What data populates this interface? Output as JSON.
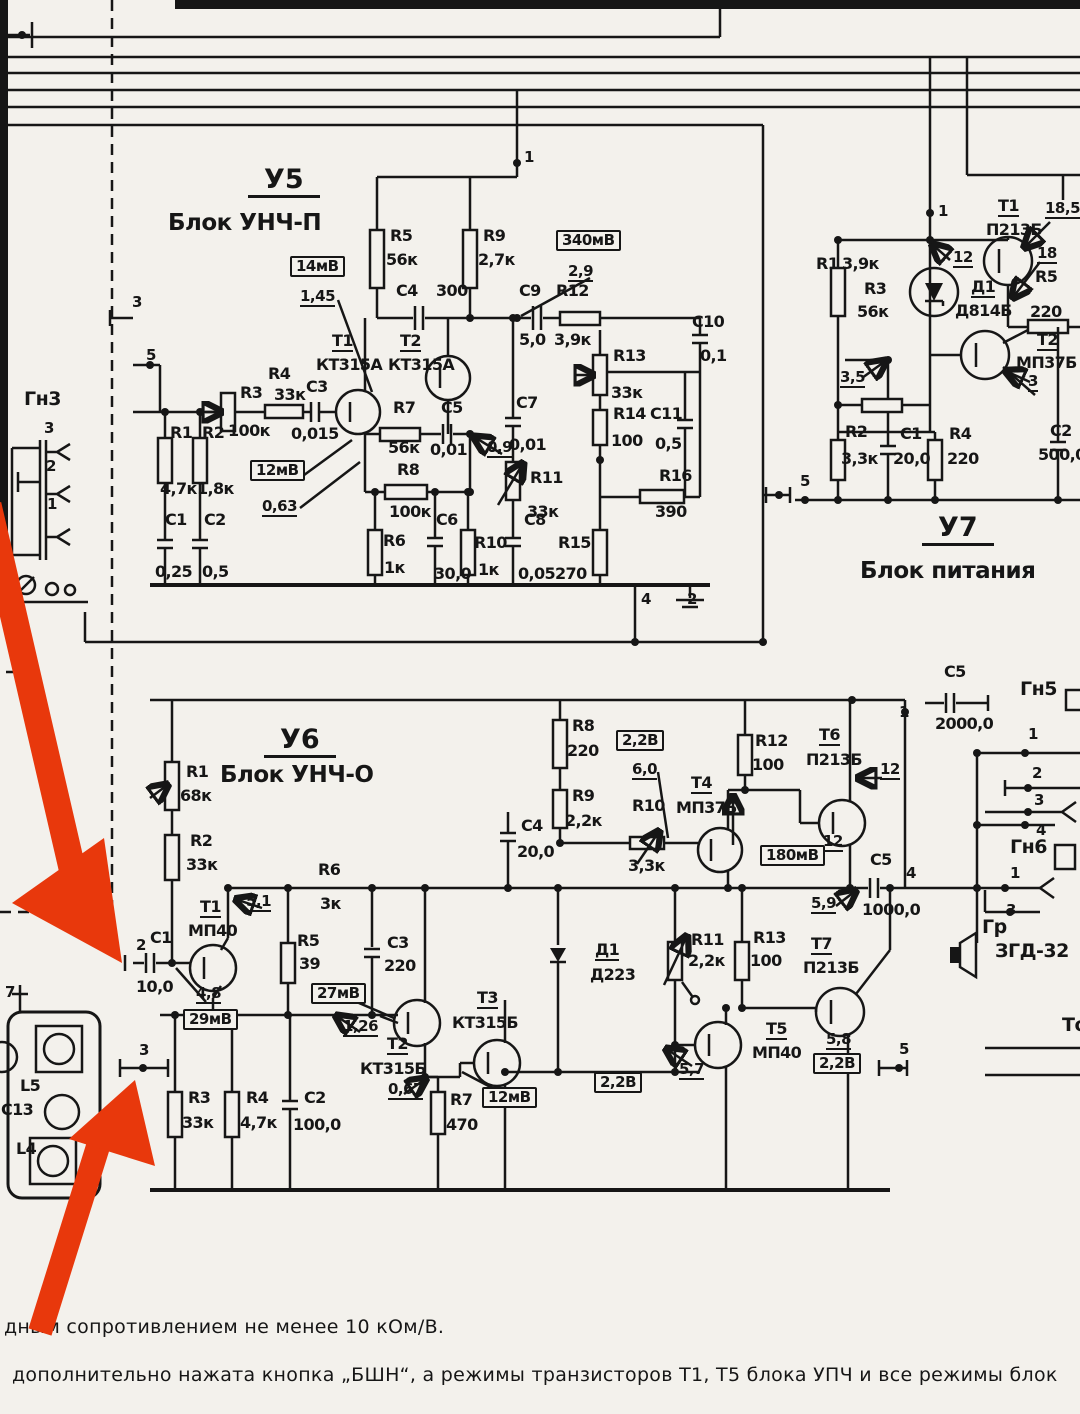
{
  "canvas": {
    "width": 1080,
    "height": 1414,
    "bg": "#f3f1ec",
    "ink": "#161616"
  },
  "arrow": {
    "color": "#e8380c",
    "count": 2,
    "meaning": "red annotation arrows"
  },
  "blocks": [
    {
      "id": "У5",
      "name": "Блок УНЧ-П"
    },
    {
      "id": "У6",
      "name": "Блок УНЧ-О"
    },
    {
      "id": "У7",
      "name": "Блок питания"
    }
  ],
  "connectors": [
    "Гн3",
    "Гн5",
    "Гн6",
    "Гр ЗГД-32"
  ],
  "notes": [
    "дным  сопротивлением не менее  10 кОм/В.",
    "дополнительно нажата кнопка „БШН“, а режимы транзисторов Т1, Т5 блока УПЧ и все режимы блок"
  ],
  "labels": [
    {
      "t": "У5",
      "x": 248,
      "y": 166,
      "s": "t1",
      "n": "block-u5-id"
    },
    {
      "t": "Блок УНЧ-П",
      "x": 168,
      "y": 212,
      "s": "t2",
      "n": "block-u5-name"
    },
    {
      "t": "1",
      "x": 524,
      "y": 150,
      "s": "p"
    },
    {
      "t": "R5",
      "x": 390,
      "y": 228,
      "s": "r"
    },
    {
      "t": "56к",
      "x": 386,
      "y": 252,
      "s": "r"
    },
    {
      "t": "R9",
      "x": 483,
      "y": 228,
      "s": "r"
    },
    {
      "t": "2,7к",
      "x": 478,
      "y": 252,
      "s": "r"
    },
    {
      "t": "14мВ",
      "x": 290,
      "y": 256,
      "s": "b"
    },
    {
      "t": "1,45",
      "x": 300,
      "y": 289,
      "s": "m"
    },
    {
      "t": "340мВ",
      "x": 556,
      "y": 230,
      "s": "b"
    },
    {
      "t": "2,9",
      "x": 568,
      "y": 264,
      "s": "m"
    },
    {
      "t": "C4",
      "x": 396,
      "y": 283,
      "s": "r"
    },
    {
      "t": "300",
      "x": 436,
      "y": 283,
      "s": "r"
    },
    {
      "t": "C9",
      "x": 519,
      "y": 283,
      "s": "r"
    },
    {
      "t": "5,0",
      "x": 519,
      "y": 332,
      "s": "r"
    },
    {
      "t": "R12",
      "x": 556,
      "y": 283,
      "s": "r"
    },
    {
      "t": "3,9к",
      "x": 554,
      "y": 332,
      "s": "r"
    },
    {
      "t": "T1",
      "x": 332,
      "y": 333,
      "s": "d"
    },
    {
      "t": "КТ315А",
      "x": 316,
      "y": 357,
      "s": "r"
    },
    {
      "t": "T2",
      "x": 400,
      "y": 333,
      "s": "d"
    },
    {
      "t": "КТ315А",
      "x": 388,
      "y": 357,
      "s": "r"
    },
    {
      "t": "R3",
      "x": 240,
      "y": 385,
      "s": "r"
    },
    {
      "t": "100к",
      "x": 228,
      "y": 423,
      "s": "r"
    },
    {
      "t": "R4",
      "x": 268,
      "y": 366,
      "s": "r"
    },
    {
      "t": "33к",
      "x": 274,
      "y": 387,
      "s": "r"
    },
    {
      "t": "C3",
      "x": 306,
      "y": 379,
      "s": "r"
    },
    {
      "t": "0,015",
      "x": 291,
      "y": 426,
      "s": "r"
    },
    {
      "t": "12мВ",
      "x": 250,
      "y": 460,
      "s": "b"
    },
    {
      "t": "0,63",
      "x": 262,
      "y": 499,
      "s": "m"
    },
    {
      "t": "R1",
      "x": 170,
      "y": 425,
      "s": "r"
    },
    {
      "t": "4,7к",
      "x": 160,
      "y": 481,
      "s": "r"
    },
    {
      "t": "R2",
      "x": 202,
      "y": 425,
      "s": "r"
    },
    {
      "t": "1,8к",
      "x": 197,
      "y": 481,
      "s": "r"
    },
    {
      "t": "C1",
      "x": 165,
      "y": 512,
      "s": "r"
    },
    {
      "t": "0,25",
      "x": 155,
      "y": 564,
      "s": "r"
    },
    {
      "t": "C2",
      "x": 204,
      "y": 512,
      "s": "r"
    },
    {
      "t": "0,5",
      "x": 202,
      "y": 564,
      "s": "r"
    },
    {
      "t": "R7",
      "x": 393,
      "y": 400,
      "s": "r"
    },
    {
      "t": "56к",
      "x": 388,
      "y": 440,
      "s": "r"
    },
    {
      "t": "C5",
      "x": 441,
      "y": 400,
      "s": "r"
    },
    {
      "t": "0,01",
      "x": 430,
      "y": 442,
      "s": "r"
    },
    {
      "t": "0,9",
      "x": 487,
      "y": 440,
      "s": "m"
    },
    {
      "t": "R8",
      "x": 397,
      "y": 462,
      "s": "r"
    },
    {
      "t": "100к",
      "x": 389,
      "y": 504,
      "s": "r"
    },
    {
      "t": "R6",
      "x": 383,
      "y": 533,
      "s": "r"
    },
    {
      "t": "1к",
      "x": 384,
      "y": 560,
      "s": "r"
    },
    {
      "t": "C6",
      "x": 436,
      "y": 512,
      "s": "r"
    },
    {
      "t": "30,0",
      "x": 434,
      "y": 566,
      "s": "r"
    },
    {
      "t": "R10",
      "x": 474,
      "y": 535,
      "s": "r"
    },
    {
      "t": "1к",
      "x": 478,
      "y": 562,
      "s": "r"
    },
    {
      "t": "C8",
      "x": 524,
      "y": 512,
      "s": "r"
    },
    {
      "t": "0,05",
      "x": 518,
      "y": 566,
      "s": "r"
    },
    {
      "t": "R15",
      "x": 558,
      "y": 535,
      "s": "r"
    },
    {
      "t": "270",
      "x": 555,
      "y": 566,
      "s": "r"
    },
    {
      "t": "C7",
      "x": 516,
      "y": 395,
      "s": "r"
    },
    {
      "t": "0,01",
      "x": 509,
      "y": 437,
      "s": "r"
    },
    {
      "t": "R11",
      "x": 530,
      "y": 470,
      "s": "r"
    },
    {
      "t": "33к",
      "x": 527,
      "y": 504,
      "s": "r"
    },
    {
      "t": "R13",
      "x": 613,
      "y": 348,
      "s": "r"
    },
    {
      "t": "33к",
      "x": 611,
      "y": 385,
      "s": "r"
    },
    {
      "t": "R14",
      "x": 613,
      "y": 406,
      "s": "r"
    },
    {
      "t": "100",
      "x": 611,
      "y": 433,
      "s": "r"
    },
    {
      "t": "C11",
      "x": 650,
      "y": 406,
      "s": "r"
    },
    {
      "t": "0,5",
      "x": 655,
      "y": 436,
      "s": "r"
    },
    {
      "t": "C10",
      "x": 692,
      "y": 314,
      "s": "r"
    },
    {
      "t": "0,1",
      "x": 700,
      "y": 348,
      "s": "r"
    },
    {
      "t": "R16",
      "x": 659,
      "y": 468,
      "s": "r"
    },
    {
      "t": "390",
      "x": 655,
      "y": 504,
      "s": "r"
    },
    {
      "t": "4",
      "x": 641,
      "y": 592,
      "s": "p"
    },
    {
      "t": "2",
      "x": 687,
      "y": 592,
      "s": "p"
    },
    {
      "t": "3",
      "x": 132,
      "y": 295,
      "s": "p"
    },
    {
      "t": "5",
      "x": 146,
      "y": 348,
      "s": "p"
    },
    {
      "t": "1",
      "x": 938,
      "y": 204,
      "s": "p"
    },
    {
      "t": "T1",
      "x": 998,
      "y": 198,
      "s": "d"
    },
    {
      "t": "П213Б",
      "x": 986,
      "y": 222,
      "s": "r"
    },
    {
      "t": "18,5",
      "x": 1045,
      "y": 201,
      "s": "m"
    },
    {
      "t": "12",
      "x": 953,
      "y": 250,
      "s": "m"
    },
    {
      "t": "R1",
      "x": 816,
      "y": 256,
      "s": "r"
    },
    {
      "t": "3,9к",
      "x": 842,
      "y": 256,
      "s": "r"
    },
    {
      "t": "R3",
      "x": 864,
      "y": 281,
      "s": "r"
    },
    {
      "t": "56к",
      "x": 857,
      "y": 304,
      "s": "r"
    },
    {
      "t": "Д1",
      "x": 971,
      "y": 279,
      "s": "d"
    },
    {
      "t": "Д814Б",
      "x": 955,
      "y": 303,
      "s": "r"
    },
    {
      "t": "R5",
      "x": 1035,
      "y": 269,
      "s": "r"
    },
    {
      "t": "220",
      "x": 1030,
      "y": 304,
      "s": "r"
    },
    {
      "t": "18",
      "x": 1037,
      "y": 246,
      "s": "m"
    },
    {
      "t": "T2",
      "x": 1037,
      "y": 332,
      "s": "d"
    },
    {
      "t": "МП37Б",
      "x": 1016,
      "y": 355,
      "s": "r"
    },
    {
      "t": "3",
      "x": 1028,
      "y": 374,
      "s": "m"
    },
    {
      "t": "3,5",
      "x": 840,
      "y": 370,
      "s": "m"
    },
    {
      "t": "R2",
      "x": 845,
      "y": 424,
      "s": "r"
    },
    {
      "t": "3,3к",
      "x": 841,
      "y": 451,
      "s": "r"
    },
    {
      "t": "C1",
      "x": 900,
      "y": 426,
      "s": "r"
    },
    {
      "t": "20,0",
      "x": 893,
      "y": 451,
      "s": "r"
    },
    {
      "t": "R4",
      "x": 949,
      "y": 426,
      "s": "r"
    },
    {
      "t": "220",
      "x": 947,
      "y": 451,
      "s": "r"
    },
    {
      "t": "C2",
      "x": 1050,
      "y": 423,
      "s": "r"
    },
    {
      "t": "500,0",
      "x": 1038,
      "y": 447,
      "s": "r"
    },
    {
      "t": "5",
      "x": 800,
      "y": 474,
      "s": "p"
    },
    {
      "t": "У7",
      "x": 922,
      "y": 514,
      "s": "t1",
      "n": "block-u7-id"
    },
    {
      "t": "Блок питания",
      "x": 860,
      "y": 560,
      "s": "t2",
      "n": "block-u7-name"
    },
    {
      "t": "У6",
      "x": 264,
      "y": 726,
      "s": "t1",
      "n": "block-u6-id"
    },
    {
      "t": "Блок УНЧ-О",
      "x": 220,
      "y": 764,
      "s": "t2",
      "n": "block-u6-name"
    },
    {
      "t": "1",
      "x": 899,
      "y": 705,
      "s": "p"
    },
    {
      "t": "R1",
      "x": 186,
      "y": 764,
      "s": "r"
    },
    {
      "t": "68к",
      "x": 180,
      "y": 788,
      "s": "r"
    },
    {
      "t": "R2",
      "x": 190,
      "y": 833,
      "s": "r"
    },
    {
      "t": "33к",
      "x": 186,
      "y": 857,
      "s": "r"
    },
    {
      "t": "T1",
      "x": 200,
      "y": 899,
      "s": "d"
    },
    {
      "t": "МП40",
      "x": 188,
      "y": 923,
      "s": "r"
    },
    {
      "t": "5,1",
      "x": 246,
      "y": 894,
      "s": "m"
    },
    {
      "t": "R6",
      "x": 318,
      "y": 862,
      "s": "r"
    },
    {
      "t": "3к",
      "x": 320,
      "y": 896,
      "s": "r"
    },
    {
      "t": "C4",
      "x": 521,
      "y": 818,
      "s": "r"
    },
    {
      "t": "20,0",
      "x": 517,
      "y": 844,
      "s": "r"
    },
    {
      "t": "R8",
      "x": 572,
      "y": 718,
      "s": "r"
    },
    {
      "t": "220",
      "x": 567,
      "y": 743,
      "s": "r"
    },
    {
      "t": "2,2В",
      "x": 616,
      "y": 730,
      "s": "b"
    },
    {
      "t": "6,0",
      "x": 632,
      "y": 762,
      "s": "m"
    },
    {
      "t": "R9",
      "x": 572,
      "y": 788,
      "s": "r"
    },
    {
      "t": "2,2к",
      "x": 565,
      "y": 813,
      "s": "r"
    },
    {
      "t": "R10",
      "x": 632,
      "y": 798,
      "s": "r"
    },
    {
      "t": "3,3к",
      "x": 628,
      "y": 858,
      "s": "r"
    },
    {
      "t": "T4",
      "x": 691,
      "y": 775,
      "s": "d"
    },
    {
      "t": "МП37Б",
      "x": 676,
      "y": 800,
      "s": "r"
    },
    {
      "t": "R12",
      "x": 755,
      "y": 733,
      "s": "r"
    },
    {
      "t": "100",
      "x": 752,
      "y": 757,
      "s": "r"
    },
    {
      "t": "T6",
      "x": 819,
      "y": 727,
      "s": "d"
    },
    {
      "t": "П213Б",
      "x": 806,
      "y": 752,
      "s": "r"
    },
    {
      "t": "12",
      "x": 880,
      "y": 762,
      "s": "m"
    },
    {
      "t": "180мВ",
      "x": 760,
      "y": 845,
      "s": "b"
    },
    {
      "t": "12",
      "x": 823,
      "y": 834,
      "s": "m"
    },
    {
      "t": "C5",
      "x": 870,
      "y": 852,
      "s": "r"
    },
    {
      "t": "1000,0",
      "x": 862,
      "y": 902,
      "s": "r"
    },
    {
      "t": "5,9",
      "x": 811,
      "y": 896,
      "s": "m"
    },
    {
      "t": "4",
      "x": 906,
      "y": 866,
      "s": "p"
    },
    {
      "t": "2",
      "x": 136,
      "y": 938,
      "s": "p"
    },
    {
      "t": "C1",
      "x": 150,
      "y": 930,
      "s": "r"
    },
    {
      "t": "10,0",
      "x": 136,
      "y": 979,
      "s": "r"
    },
    {
      "t": "4,8",
      "x": 196,
      "y": 986,
      "s": "m"
    },
    {
      "t": "29мВ",
      "x": 183,
      "y": 1009,
      "s": "b"
    },
    {
      "t": "3",
      "x": 139,
      "y": 1043,
      "s": "p"
    },
    {
      "t": "R3",
      "x": 188,
      "y": 1090,
      "s": "r"
    },
    {
      "t": "33к",
      "x": 182,
      "y": 1115,
      "s": "r"
    },
    {
      "t": "R4",
      "x": 246,
      "y": 1090,
      "s": "r"
    },
    {
      "t": "4,7к",
      "x": 240,
      "y": 1115,
      "s": "r"
    },
    {
      "t": "C2",
      "x": 304,
      "y": 1090,
      "s": "r"
    },
    {
      "t": "100,0",
      "x": 293,
      "y": 1117,
      "s": "r"
    },
    {
      "t": "R5",
      "x": 297,
      "y": 933,
      "s": "r"
    },
    {
      "t": "39",
      "x": 299,
      "y": 956,
      "s": "r"
    },
    {
      "t": "C3",
      "x": 387,
      "y": 935,
      "s": "r"
    },
    {
      "t": "220",
      "x": 384,
      "y": 958,
      "s": "r"
    },
    {
      "t": "27мВ",
      "x": 311,
      "y": 983,
      "s": "b"
    },
    {
      "t": "1,26",
      "x": 343,
      "y": 1019,
      "s": "m"
    },
    {
      "t": "T2",
      "x": 387,
      "y": 1036,
      "s": "d"
    },
    {
      "t": "КТ315Б",
      "x": 360,
      "y": 1061,
      "s": "r"
    },
    {
      "t": "0,67",
      "x": 388,
      "y": 1082,
      "s": "m"
    },
    {
      "t": "T3",
      "x": 477,
      "y": 990,
      "s": "d"
    },
    {
      "t": "КТ315Б",
      "x": 452,
      "y": 1015,
      "s": "r"
    },
    {
      "t": "R7",
      "x": 450,
      "y": 1092,
      "s": "r"
    },
    {
      "t": "470",
      "x": 446,
      "y": 1117,
      "s": "r"
    },
    {
      "t": "12мВ",
      "x": 482,
      "y": 1087,
      "s": "b"
    },
    {
      "t": "Д1",
      "x": 595,
      "y": 942,
      "s": "d"
    },
    {
      "t": "Д223",
      "x": 590,
      "y": 967,
      "s": "r"
    },
    {
      "t": "R11",
      "x": 691,
      "y": 932,
      "s": "r"
    },
    {
      "t": "2,2к",
      "x": 688,
      "y": 953,
      "s": "r"
    },
    {
      "t": "R13",
      "x": 753,
      "y": 930,
      "s": "r"
    },
    {
      "t": "100",
      "x": 750,
      "y": 953,
      "s": "r"
    },
    {
      "t": "T7",
      "x": 811,
      "y": 936,
      "s": "d"
    },
    {
      "t": "П213Б",
      "x": 803,
      "y": 960,
      "s": "r"
    },
    {
      "t": "T5",
      "x": 766,
      "y": 1021,
      "s": "d"
    },
    {
      "t": "МП40",
      "x": 752,
      "y": 1045,
      "s": "r"
    },
    {
      "t": "5,8",
      "x": 826,
      "y": 1032,
      "s": "m"
    },
    {
      "t": "2,2В",
      "x": 813,
      "y": 1053,
      "s": "b"
    },
    {
      "t": "2,2В",
      "x": 594,
      "y": 1072,
      "s": "b"
    },
    {
      "t": "5,7",
      "x": 679,
      "y": 1062,
      "s": "m"
    },
    {
      "t": "5",
      "x": 899,
      "y": 1042,
      "s": "p"
    },
    {
      "t": "С5",
      "x": 944,
      "y": 664,
      "s": "r"
    },
    {
      "t": "2000,0",
      "x": 935,
      "y": 716,
      "s": "r"
    },
    {
      "t": "Гн5",
      "x": 1020,
      "y": 680,
      "s": "c",
      "n": "connector-gn5"
    },
    {
      "t": "1",
      "x": 1028,
      "y": 727,
      "s": "p"
    },
    {
      "t": "2",
      "x": 1032,
      "y": 766,
      "s": "p"
    },
    {
      "t": "3",
      "x": 1034,
      "y": 793,
      "s": "p"
    },
    {
      "t": "4",
      "x": 1036,
      "y": 823,
      "s": "p"
    },
    {
      "t": "Гн6",
      "x": 1010,
      "y": 838,
      "s": "c",
      "n": "connector-gn6"
    },
    {
      "t": "1",
      "x": 1010,
      "y": 866,
      "s": "p"
    },
    {
      "t": "3",
      "x": 1006,
      "y": 903,
      "s": "p"
    },
    {
      "t": "Гр",
      "x": 982,
      "y": 918,
      "s": "c",
      "n": "speaker-ref"
    },
    {
      "t": "ЗГД-32",
      "x": 995,
      "y": 942,
      "s": "c",
      "n": "speaker-type"
    },
    {
      "t": "То",
      "x": 1062,
      "y": 1016,
      "s": "c"
    },
    {
      "t": "Гн3",
      "x": 24,
      "y": 390,
      "s": "c",
      "n": "connector-gn3"
    },
    {
      "t": "3",
      "x": 44,
      "y": 421,
      "s": "p"
    },
    {
      "t": "2",
      "x": 46,
      "y": 459,
      "s": "p"
    },
    {
      "t": "1",
      "x": 47,
      "y": 497,
      "s": "p"
    },
    {
      "t": "7",
      "x": 5,
      "y": 985,
      "s": "p"
    },
    {
      "t": "L5",
      "x": 20,
      "y": 1078,
      "s": "r"
    },
    {
      "t": "C13",
      "x": 1,
      "y": 1102,
      "s": "r"
    },
    {
      "t": "L4",
      "x": 16,
      "y": 1141,
      "s": "r"
    }
  ]
}
